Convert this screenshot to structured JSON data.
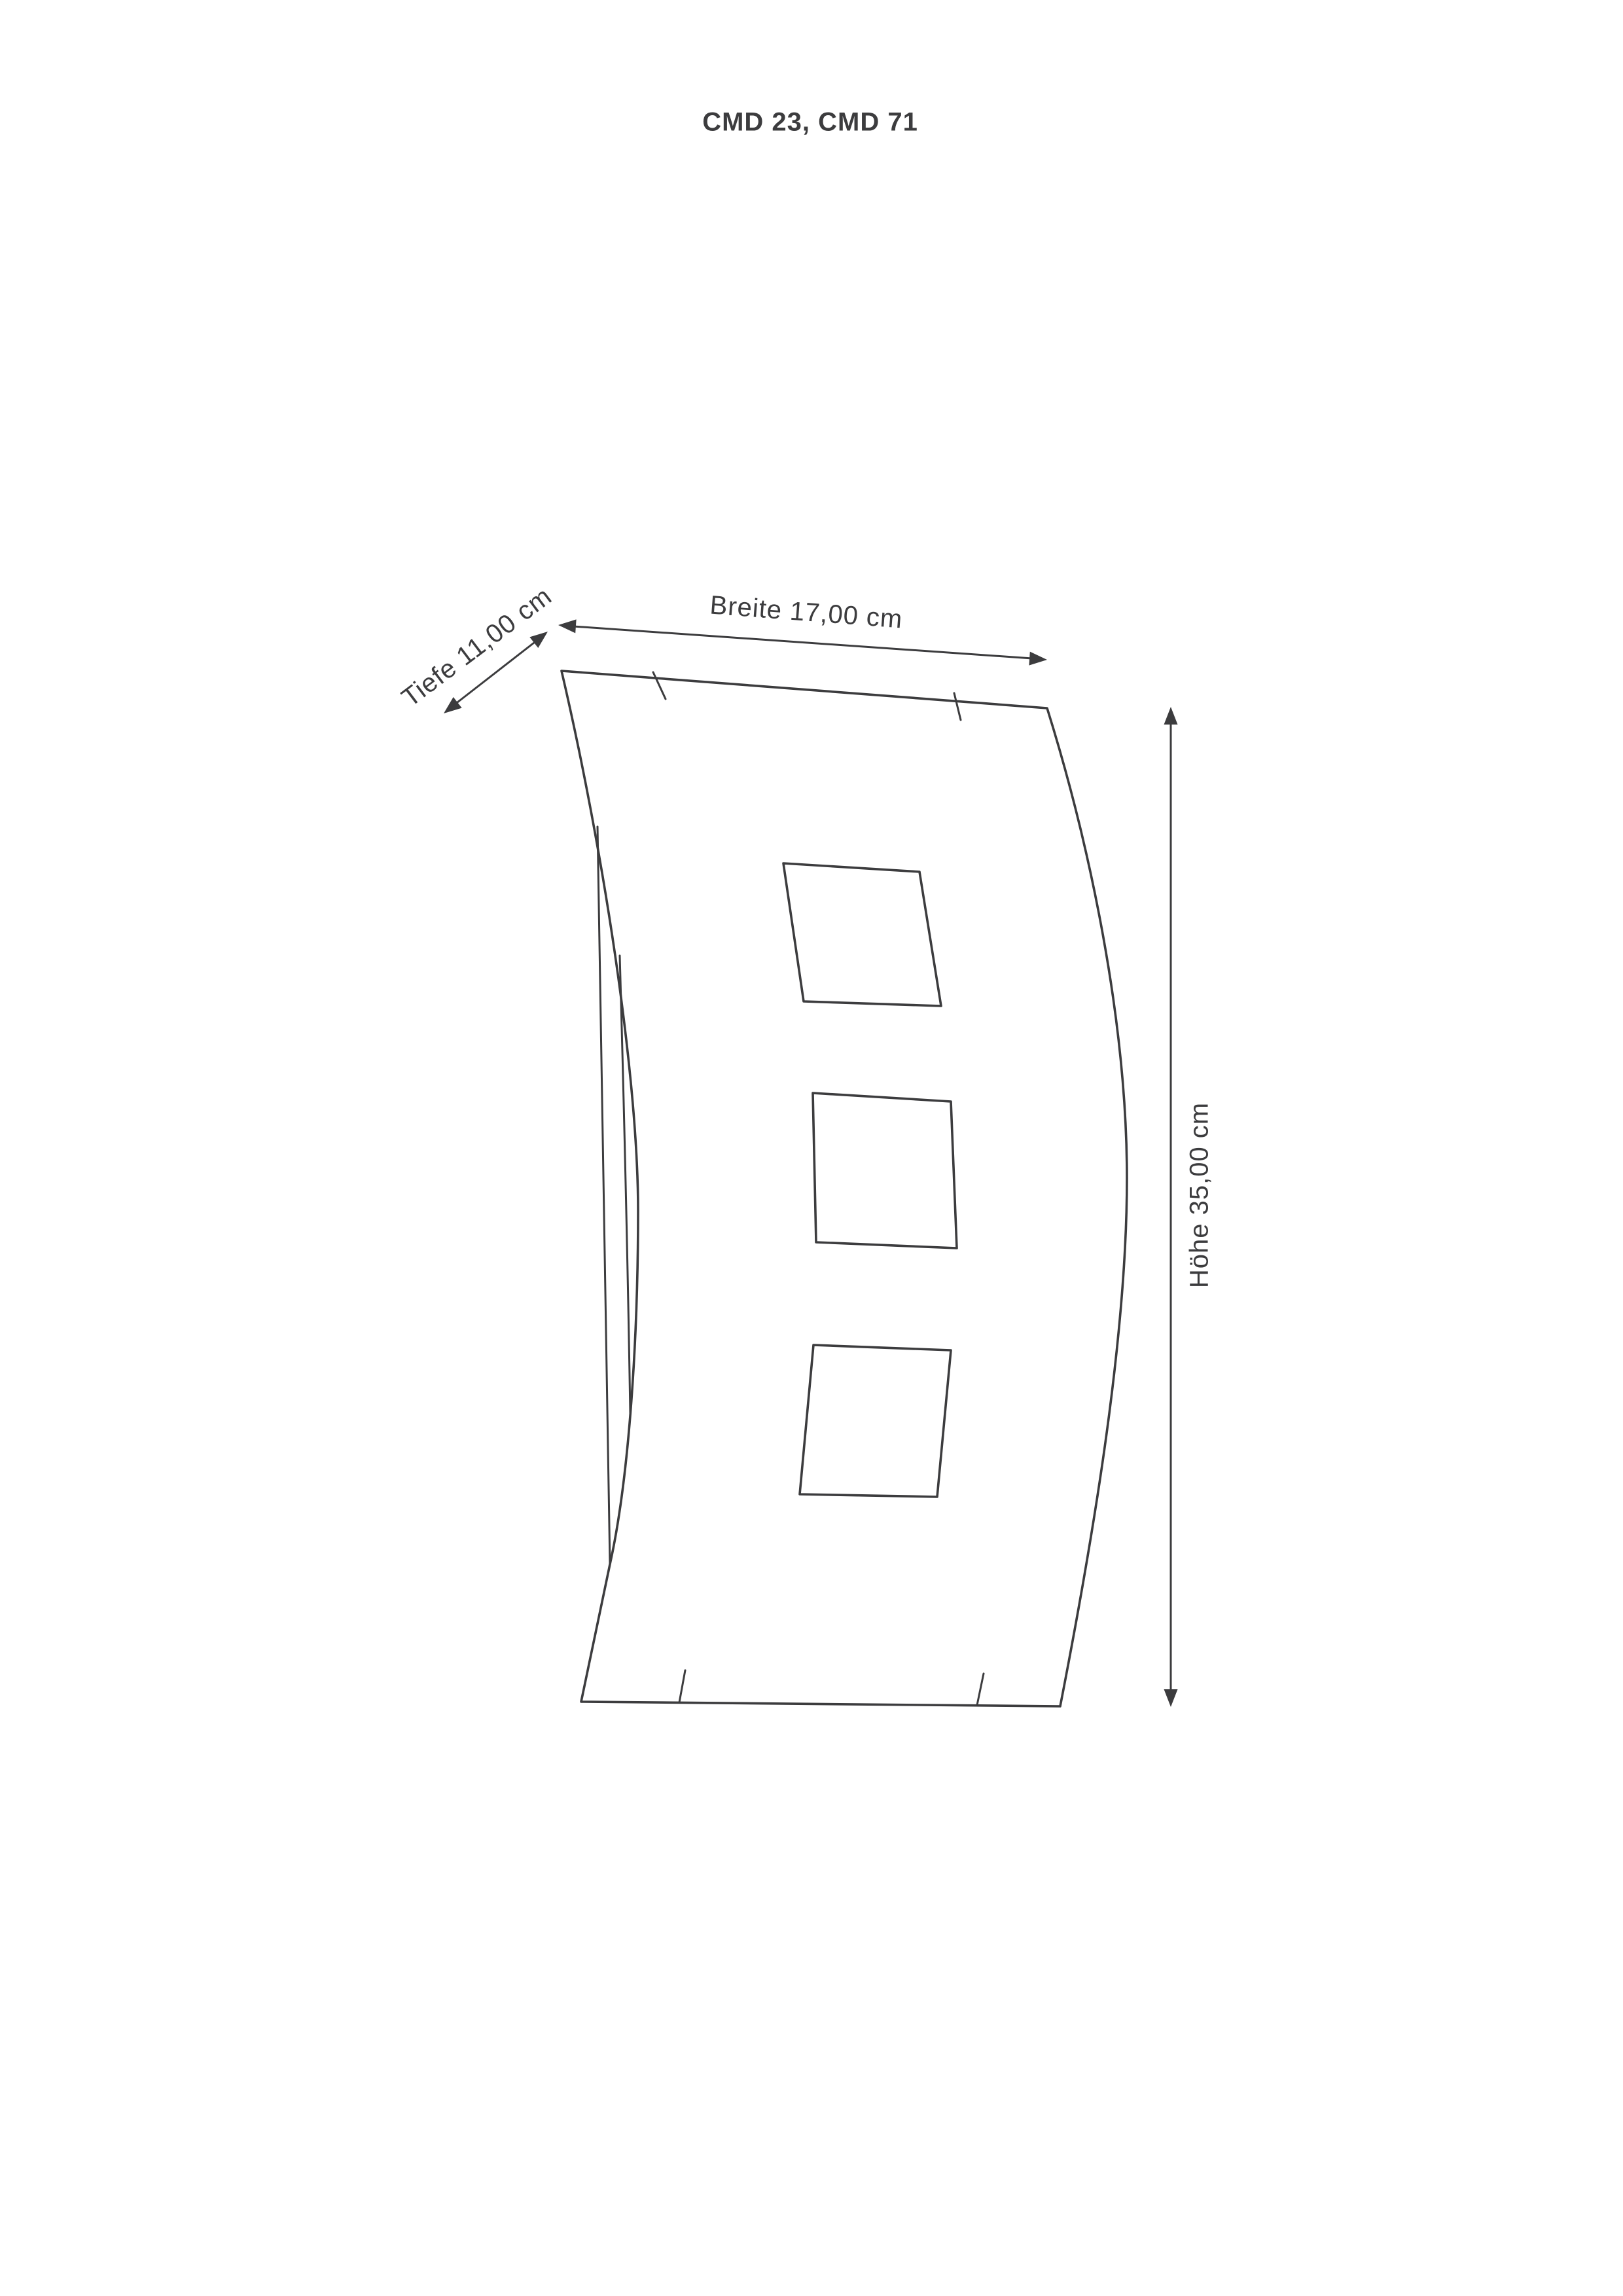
{
  "title": "CMD 23, CMD 71",
  "dimensions": {
    "depth": {
      "label": "Tiefe 11,00 cm",
      "value_cm": "11,00"
    },
    "width": {
      "label": "Breite 17,00 cm",
      "value_cm": "17,00"
    },
    "height": {
      "label": "Höhe 35,00 cm",
      "value_cm": "35,00"
    }
  },
  "colors": {
    "line": "#3c3c3e",
    "background": "#ffffff"
  }
}
